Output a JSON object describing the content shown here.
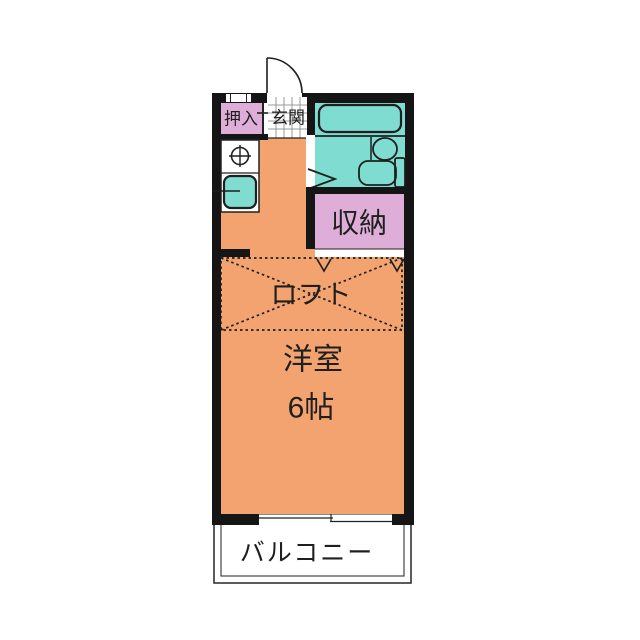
{
  "floorplan": {
    "labels": {
      "oshiire": "押入",
      "genkan": "玄関",
      "shuno": "収納",
      "loft": "ロフト",
      "room": "洋室",
      "room_size": "6帖",
      "balcony": "バルコニー"
    },
    "colors": {
      "wall": "#151515",
      "room_fill": "#F2A36F",
      "closet_fill": "#DEAED8",
      "bath_fill": "#7FDCD1",
      "tile_line": "#9a9a9a",
      "line": "#222222"
    },
    "fixtures": [
      "entrance-door-icon",
      "bathtub-icon",
      "washbasin-icon",
      "toilet-icon",
      "stove-burner-icon",
      "kitchen-sink-icon",
      "window-icon",
      "sliding-window-icon"
    ]
  }
}
